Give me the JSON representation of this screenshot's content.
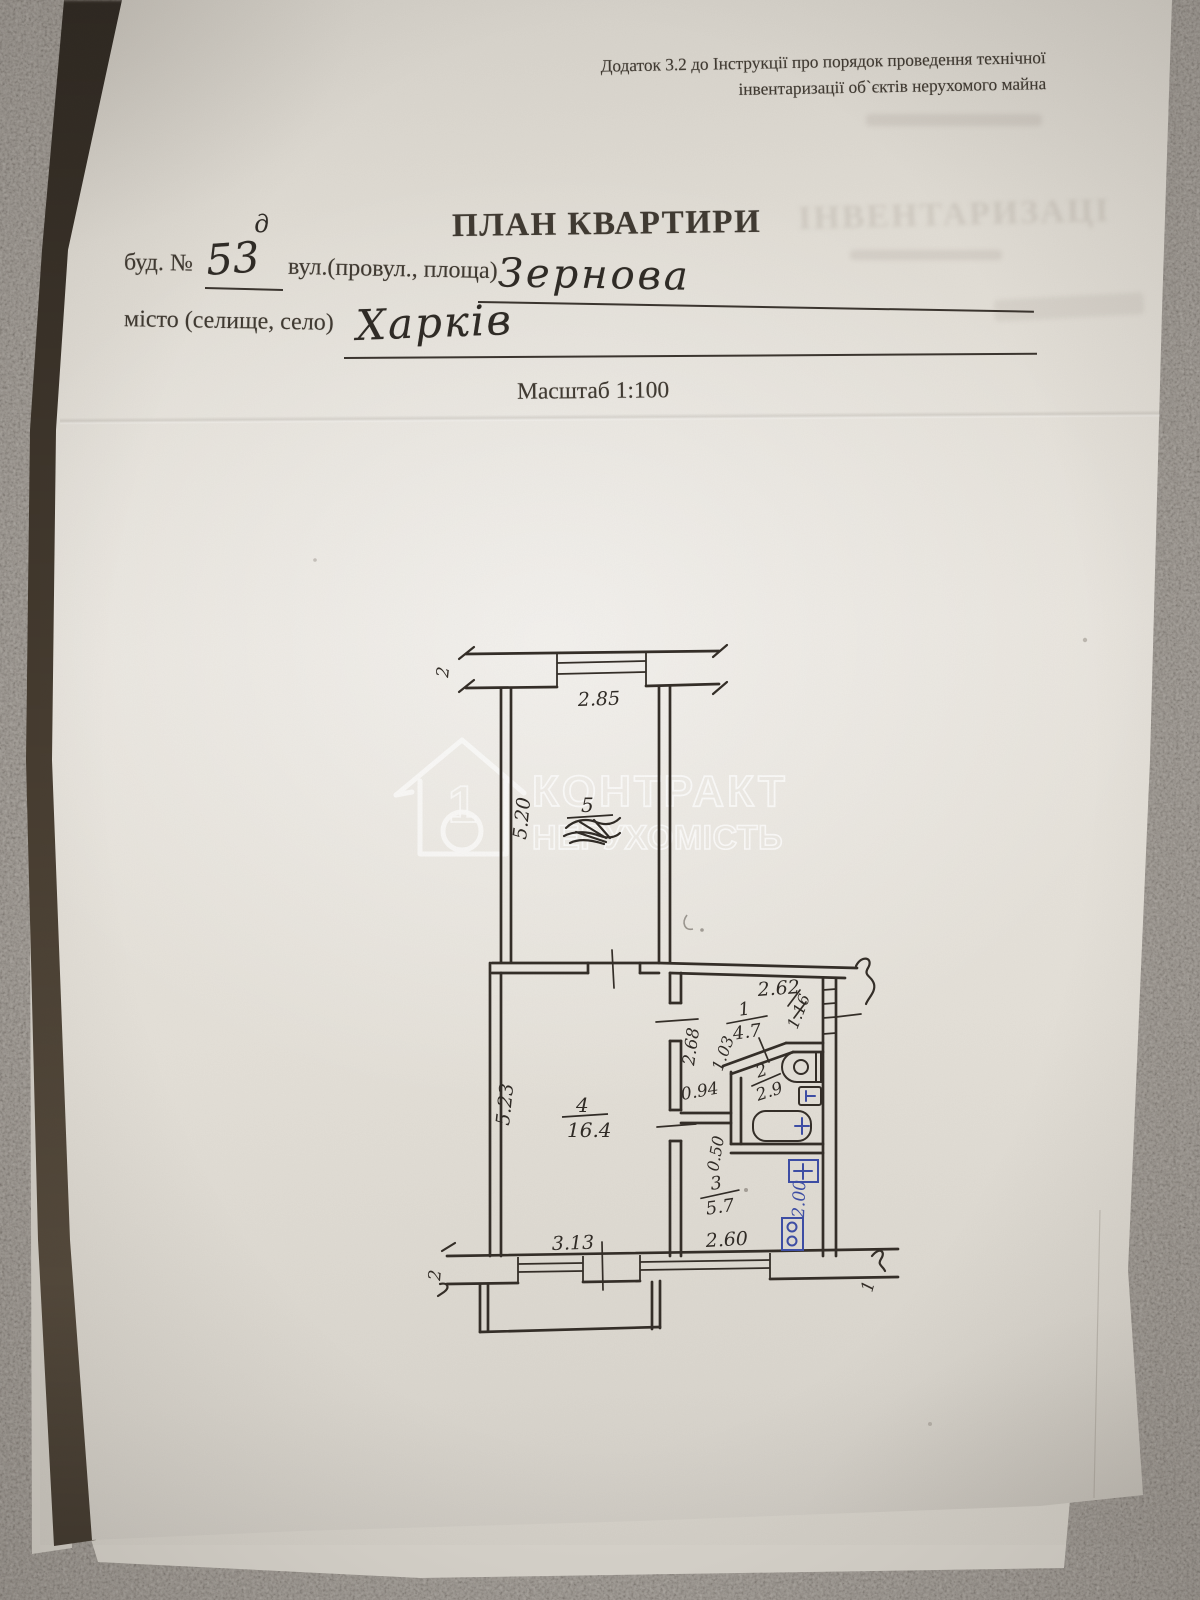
{
  "header": {
    "line1": "Додаток 3.2 до Інструкції про порядок проведення технічної",
    "line2": "інвентаризації об`єктів нерухомого майна"
  },
  "title": "ПЛАН КВАРТИРИ",
  "form": {
    "building_label": "буд. №",
    "building_value": "53",
    "building_sup": "д",
    "street_label": "вул.(провул., площа)",
    "street_value": "Зернова",
    "city_label": "місто (селище, село)",
    "city_value": "Харків",
    "scale_text": "Масштаб 1:100"
  },
  "watermark": {
    "brand_line1": "КОНТРАКТ",
    "brand_line2": "НЕРУХОМІСТЬ",
    "logo_digit": "1"
  },
  "bleedthrough": {
    "faded_text": "ІНВЕНТАРИЗАЦІ"
  },
  "plan": {
    "rooms": [
      {
        "number": "1",
        "area": "4.7"
      },
      {
        "number": "2",
        "area": "2.9"
      },
      {
        "number": "3",
        "area": "5.7"
      },
      {
        "number": "4",
        "area": "16.4"
      },
      {
        "number": "5",
        "area": "",
        "area_note": "scribbled-illegible"
      }
    ],
    "dimensions": {
      "top_window": "2.85",
      "room5_height": "5.20",
      "room4_height": "5.23",
      "room4_window": "3.13",
      "kitchen_window": "2.60",
      "hallway_width": "2.62",
      "entrance_door": "1.16",
      "corridor_length": "2.68",
      "diagonal": "1.03",
      "corridor_width": "0.94",
      "nook": "0.50",
      "kitchen_blue": "2.00"
    },
    "axis_marks": {
      "top_left": "2",
      "bottom_left": "2",
      "bottom_right": "1"
    }
  },
  "colors": {
    "ink": "#332d27",
    "blue_ink": "#3c4da6",
    "watermark": "#ffffff"
  }
}
